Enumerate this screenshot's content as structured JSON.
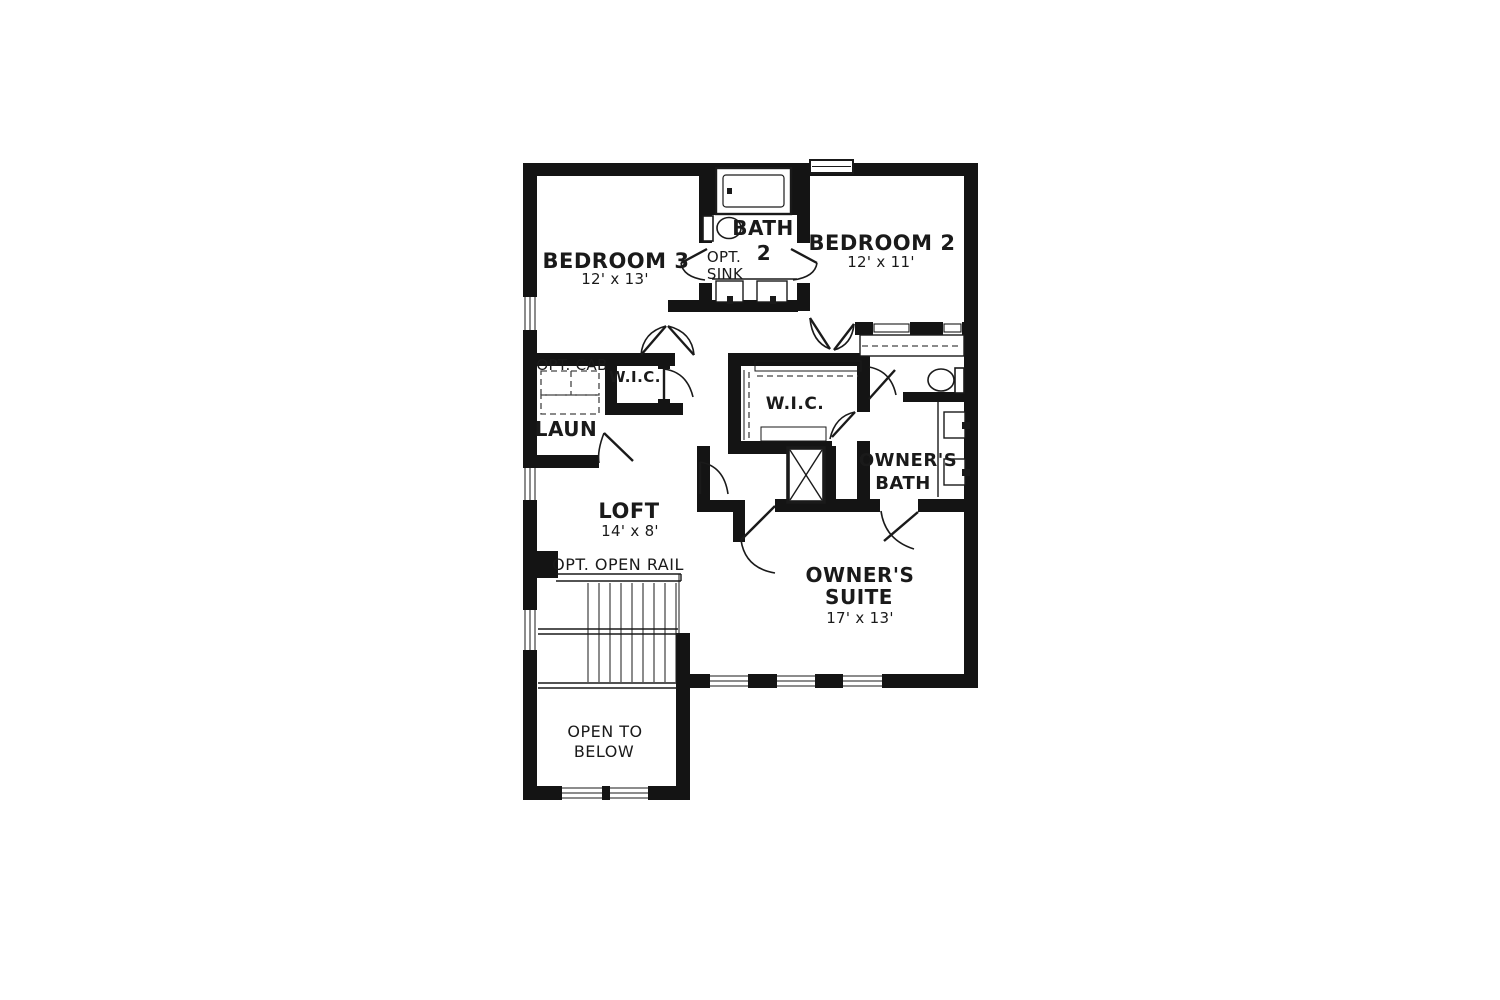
{
  "title": "Second floor plan",
  "colors": {
    "wall": "#141414",
    "background": "#ffffff",
    "line": "#1a1a1a"
  },
  "labels": {
    "bedroom3_name": "BEDROOM 3",
    "bedroom3_dims": "12' x 13'",
    "bath2_line1": "BATH",
    "bath2_line2": "2",
    "bath2_opt_line1": "OPT.",
    "bath2_opt_line2": "SINK",
    "bedroom2_name": "BEDROOM 2",
    "bedroom2_dims": "12' x 11'",
    "opt_cab": "OPT. CAB",
    "hall_wic": "W.I.C.",
    "laundry": "LAUN",
    "owners_wic": "W.I.C.",
    "owners_bath_line1": "OWNER'S",
    "owners_bath_line2": "BATH",
    "loft_name": "LOFT",
    "loft_dims": "14' x 8'",
    "opt_open_rail": "OPT. OPEN RAIL",
    "owners_suite_line1": "OWNER'S",
    "owners_suite_line2": "SUITE",
    "owners_suite_dims": "17' x 13'",
    "open_below_line1": "OPEN TO",
    "open_below_line2": "BELOW"
  },
  "fixtures": [
    "bathtub",
    "toilet",
    "double-sink-vanity",
    "walk-in-closet-rods",
    "linen-closet",
    "shower",
    "stairs",
    "windows"
  ]
}
